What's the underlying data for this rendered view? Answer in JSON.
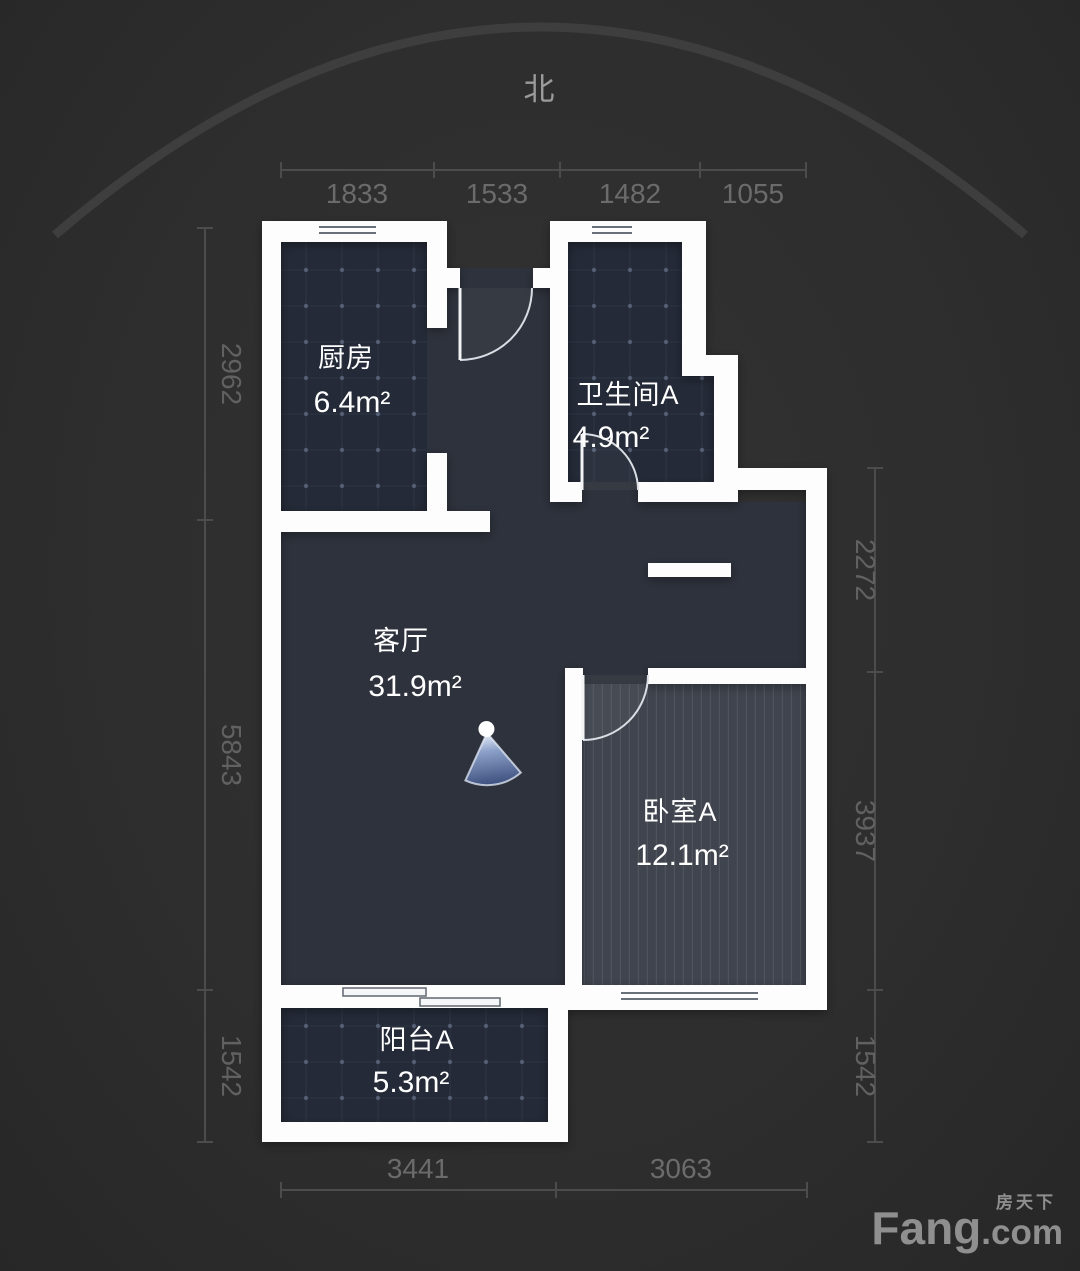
{
  "compass": {
    "label": "北"
  },
  "rooms": [
    {
      "id": "kitchen",
      "name": "厨房",
      "area": "6.4m²"
    },
    {
      "id": "bathroom",
      "name": "卫生间A",
      "area": "4.9m²"
    },
    {
      "id": "living",
      "name": "客厅",
      "area": "31.9m²"
    },
    {
      "id": "bedroom",
      "name": "卧室A",
      "area": "12.1m²"
    },
    {
      "id": "balcony",
      "name": "阳台A",
      "area": "5.3m²"
    }
  ],
  "dimensions_mm": {
    "top": [
      "1833",
      "1533",
      "1482",
      "1055"
    ],
    "left": [
      "2962",
      "5843",
      "1542"
    ],
    "right": [
      "2272",
      "3937",
      "1542"
    ],
    "bottom": [
      "3441",
      "3063"
    ]
  },
  "watermark": {
    "cn": "房天下",
    "en_main": "Fang",
    "en_suffix": ".com"
  },
  "colors": {
    "background": "#2e2e2e",
    "wall": "#ffffff",
    "tiled_room_fill": "#242a37",
    "living_fill": "#2e323c",
    "bedroom_fill": "#40444e",
    "dim_text": "#6b6b6b",
    "panorama_blue": "#4a6496"
  }
}
